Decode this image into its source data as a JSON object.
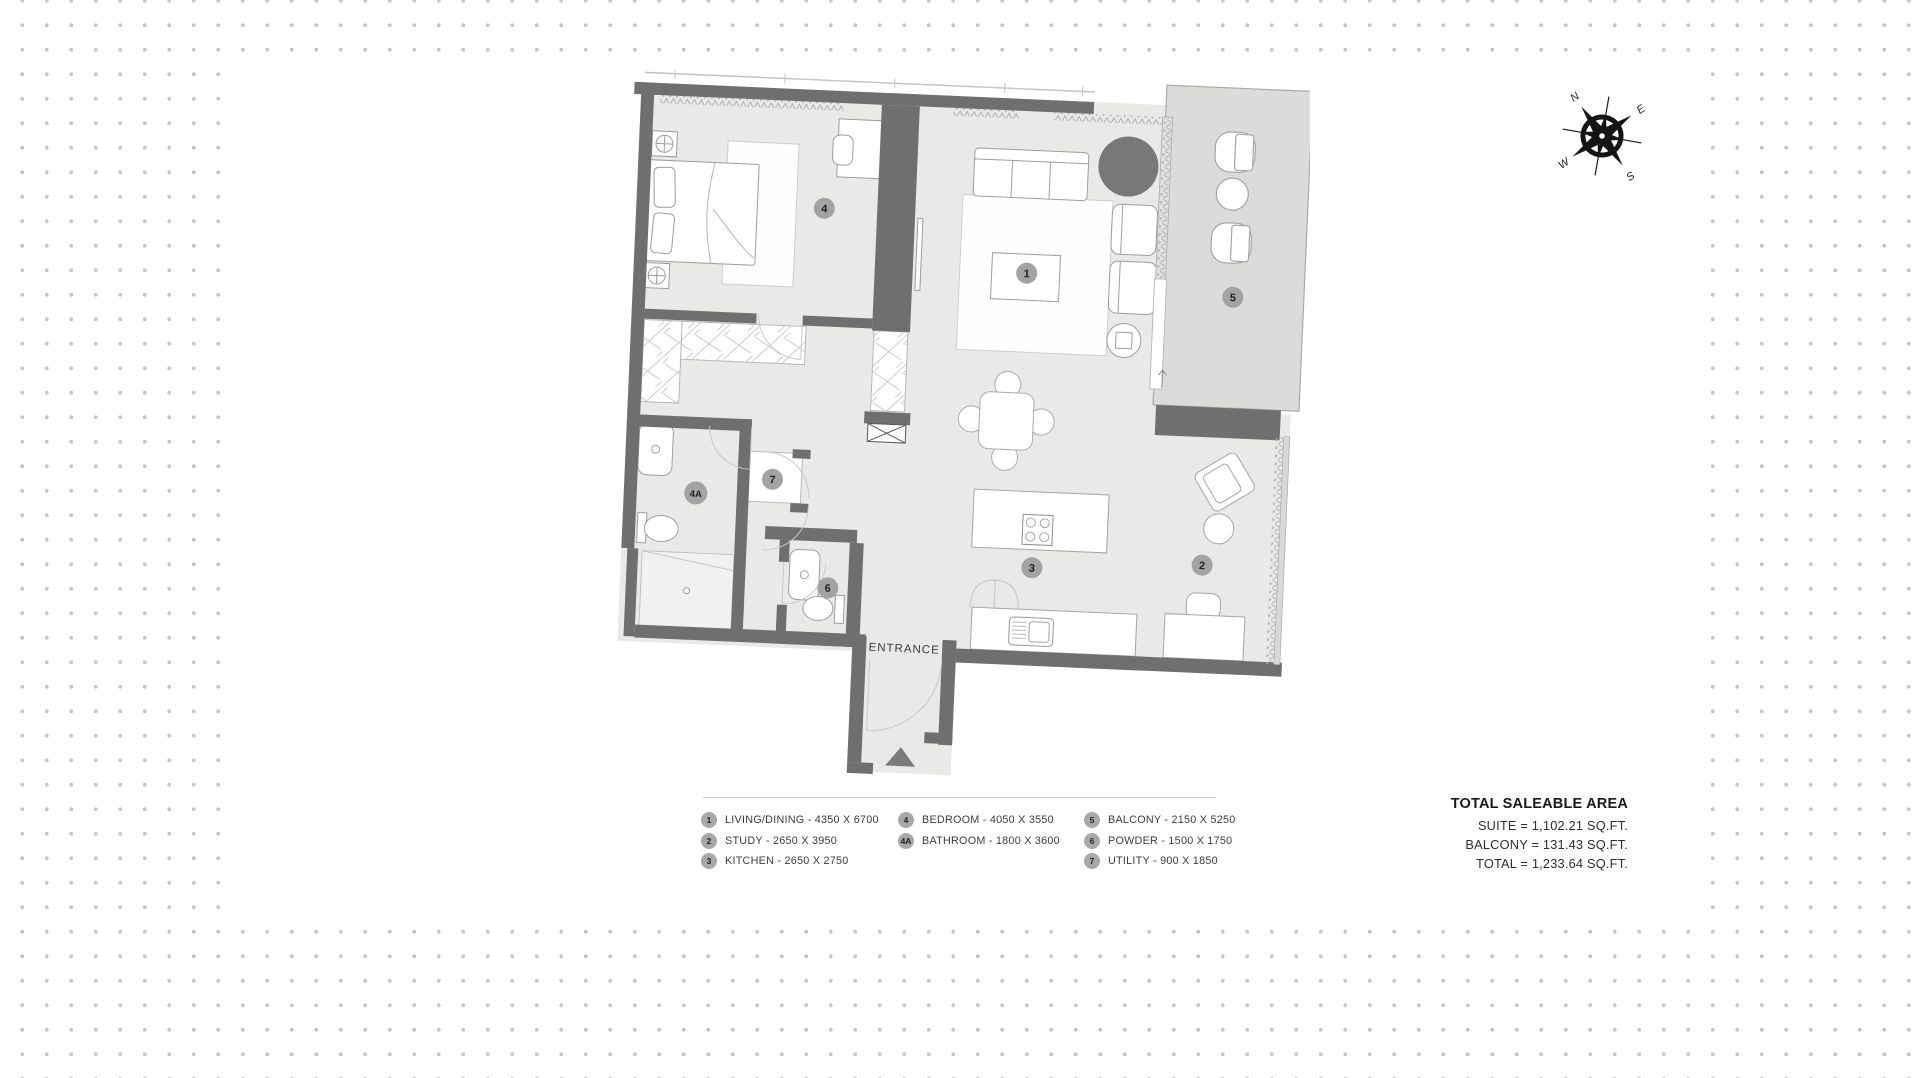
{
  "plan": {
    "entrance_label": "ENTRANCE",
    "badges": {
      "living": "1",
      "study": "2",
      "kitchen": "3",
      "bedroom": "4",
      "bathroom": "4A",
      "balcony": "5",
      "powder": "6",
      "utility": "7"
    }
  },
  "compass": {
    "n": "N",
    "e": "E",
    "s": "S",
    "w": "W"
  },
  "legend": {
    "columns": [
      {
        "items": [
          {
            "badge": "1",
            "label": "LIVING/DINING - 4350 X 6700"
          },
          {
            "badge": "2",
            "label": "STUDY - 2650 X 3950"
          },
          {
            "badge": "3",
            "label": "KITCHEN - 2650 X 2750"
          }
        ]
      },
      {
        "items": [
          {
            "badge": "4",
            "label": "BEDROOM - 4050 X 3550"
          },
          {
            "badge": "4A",
            "label": "BATHROOM - 1800 X 3600"
          }
        ]
      },
      {
        "items": [
          {
            "badge": "5",
            "label": "BALCONY - 2150 X 5250"
          },
          {
            "badge": "6",
            "label": "POWDER - 1500 X 1750"
          },
          {
            "badge": "7",
            "label": "UTILITY - 900 X 1850"
          }
        ]
      }
    ]
  },
  "totals": {
    "title": "TOTAL SALEABLE AREA",
    "lines": [
      "SUITE = 1,102.21 SQ.FT.",
      "BALCONY = 131.43 SQ.FT.",
      "TOTAL = 1,233.64 SQ.FT."
    ]
  },
  "colors": {
    "wall": "#6f6f6f",
    "floor": "#e9e9e8",
    "balcony_floor": "#dbdbda",
    "dot": "#c7c7c7",
    "badge": "#a3a3a3"
  }
}
